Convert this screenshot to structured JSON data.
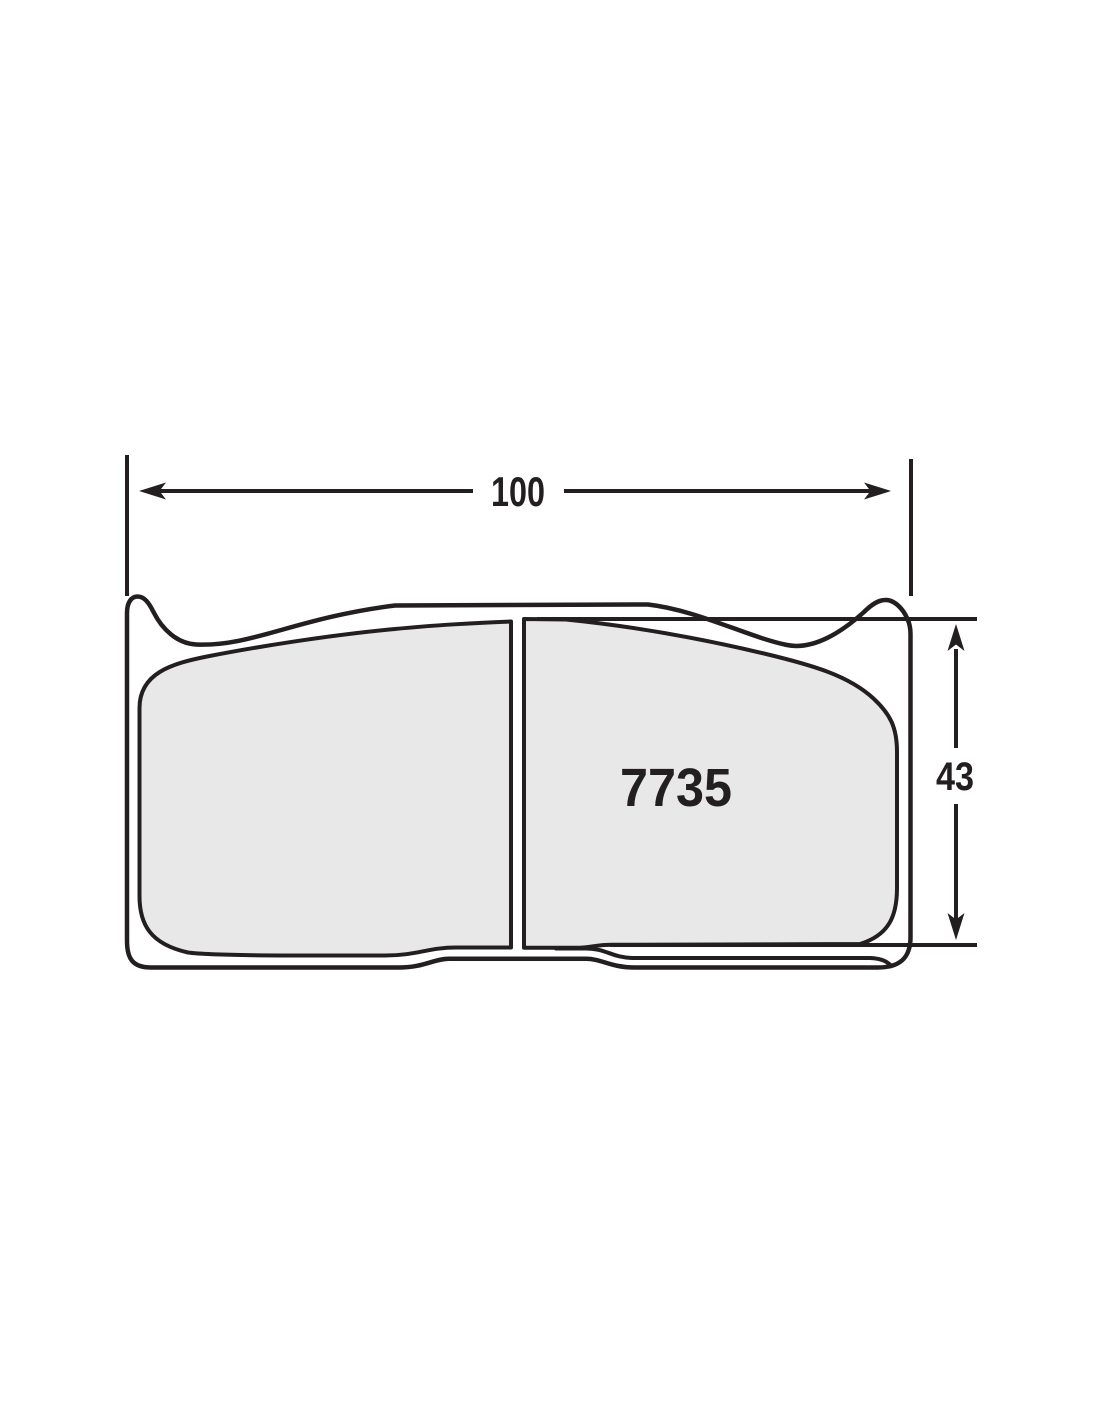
{
  "diagram": {
    "type": "brake-pad-technical-drawing",
    "part_number": "7735",
    "dimensions": {
      "width": {
        "value": "100"
      },
      "height": {
        "value": "43"
      }
    },
    "icons": {
      "width_arrow_left": "dimension-arrowhead-left",
      "width_arrow_right": "dimension-arrowhead-right",
      "height_arrow_up": "dimension-arrowhead-up",
      "height_arrow_down": "dimension-arrowhead-down"
    },
    "colors": {
      "line": "#231f20",
      "friction_fill": "#e8e8e9",
      "background": "#ffffff"
    }
  }
}
